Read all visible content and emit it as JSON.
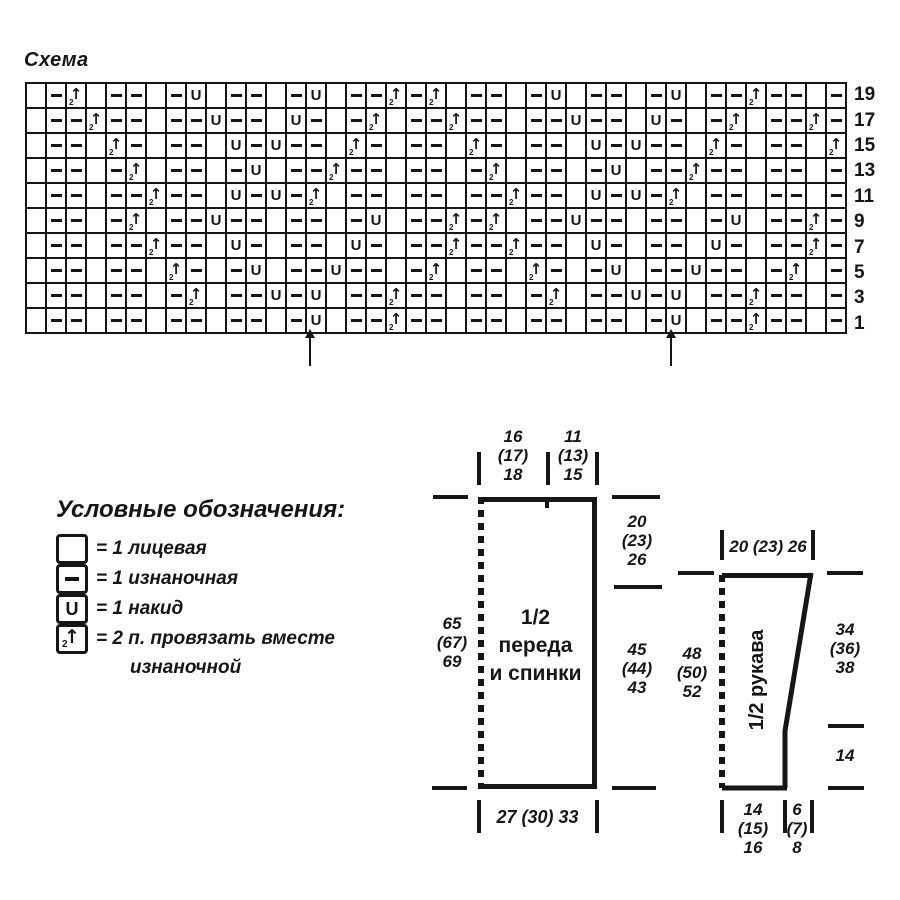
{
  "colors": {
    "ink": "#161616",
    "background": "#ffffff"
  },
  "chart": {
    "title": "Схема"
  },
  "chart_data": {
    "type": "knitting-chart",
    "columns": 41,
    "rows_shown": 10,
    "row_numbers": [
      19,
      17,
      15,
      13,
      11,
      9,
      7,
      5,
      3,
      1
    ],
    "base_pattern": "knit stitch (blank) in every column where (col-1) mod 3 = 0, purl (dash) elsewhere",
    "symbol_key": {
      "knit": "1 лицевая",
      "purl": "1 изнаночная",
      "yo": "1 накид",
      "p2tog": "2 п. провязать вместе изнаночной"
    },
    "repeat_marker_columns": [
      15,
      33
    ],
    "rows": [
      {
        "number": 19,
        "marks": {
          "3": "p2tog",
          "9": "yo",
          "15": "yo",
          "19": "p2tog",
          "21": "p2tog",
          "27": "yo",
          "33": "yo",
          "37": "p2tog"
        }
      },
      {
        "number": 17,
        "marks": {
          "4": "p2tog",
          "10": "yo",
          "14": "yo",
          "18": "p2tog",
          "22": "p2tog",
          "28": "yo",
          "32": "yo",
          "36": "p2tog",
          "40": "p2tog"
        }
      },
      {
        "number": 15,
        "marks": {
          "5": "p2tog",
          "11": "yo",
          "13": "yo",
          "17": "p2tog",
          "23": "p2tog",
          "29": "yo",
          "31": "yo",
          "35": "p2tog",
          "41": "p2tog"
        }
      },
      {
        "number": 13,
        "marks": {
          "6": "p2tog",
          "12": "yo",
          "16": "p2tog",
          "24": "p2tog",
          "30": "yo",
          "34": "p2tog"
        }
      },
      {
        "number": 11,
        "marks": {
          "7": "p2tog",
          "11": "yo",
          "13": "yo",
          "15": "p2tog",
          "25": "p2tog",
          "29": "yo",
          "31": "yo",
          "33": "p2tog"
        }
      },
      {
        "number": 9,
        "marks": {
          "6": "p2tog",
          "10": "yo",
          "18": "yo",
          "22": "p2tog",
          "24": "p2tog",
          "28": "yo",
          "36": "yo",
          "40": "p2tog"
        }
      },
      {
        "number": 7,
        "marks": {
          "7": "p2tog",
          "11": "yo",
          "17": "yo",
          "22": "p2tog",
          "25": "p2tog",
          "29": "yo",
          "35": "yo",
          "40": "p2tog"
        }
      },
      {
        "number": 5,
        "marks": {
          "8": "p2tog",
          "12": "yo",
          "16": "yo",
          "21": "p2tog",
          "26": "p2tog",
          "30": "yo",
          "34": "yo",
          "39": "p2tog"
        }
      },
      {
        "number": 3,
        "marks": {
          "9": "p2tog",
          "13": "yo",
          "15": "yo",
          "19": "p2tog",
          "27": "p2tog",
          "31": "yo",
          "33": "yo",
          "37": "p2tog"
        }
      },
      {
        "number": 1,
        "marks": {
          "15": "yo",
          "19": "p2tog",
          "33": "yo",
          "37": "p2tog"
        }
      }
    ]
  },
  "legend": {
    "title": "Условные обозначения:",
    "items": [
      {
        "symbol": "knit",
        "label": "= 1 лицевая"
      },
      {
        "symbol": "purl",
        "label": "= 1 изнаночная"
      },
      {
        "symbol": "yo",
        "label": "= 1 накид"
      },
      {
        "symbol": "p2tog",
        "label": "= 2 п. провязать вместе",
        "label_line2": "изнаночной"
      }
    ]
  },
  "schematics": {
    "body": {
      "name_line1": "1/2",
      "name_line2": "переда",
      "name_line3": "и спинки",
      "top_left_width": [
        "16",
        "(17)",
        "18"
      ],
      "top_right_width": [
        "11",
        "(13)",
        "15"
      ],
      "right_top_height": [
        "20",
        "(23)",
        "26"
      ],
      "right_bottom_height": [
        "45",
        "(44)",
        "43"
      ],
      "left_height": [
        "65",
        "(67)",
        "69"
      ],
      "bottom_width": "27 (30) 33"
    },
    "sleeve": {
      "name": "1/2 рукава",
      "top_width": "20 (23) 26",
      "left_height": [
        "48",
        "(50)",
        "52"
      ],
      "right_top_height": [
        "34",
        "(36)",
        "38"
      ],
      "right_bottom_height": "14",
      "bottom_left_width": [
        "14",
        "(15)",
        "16"
      ],
      "bottom_right_width": [
        "6",
        "(7)",
        "8"
      ]
    }
  }
}
